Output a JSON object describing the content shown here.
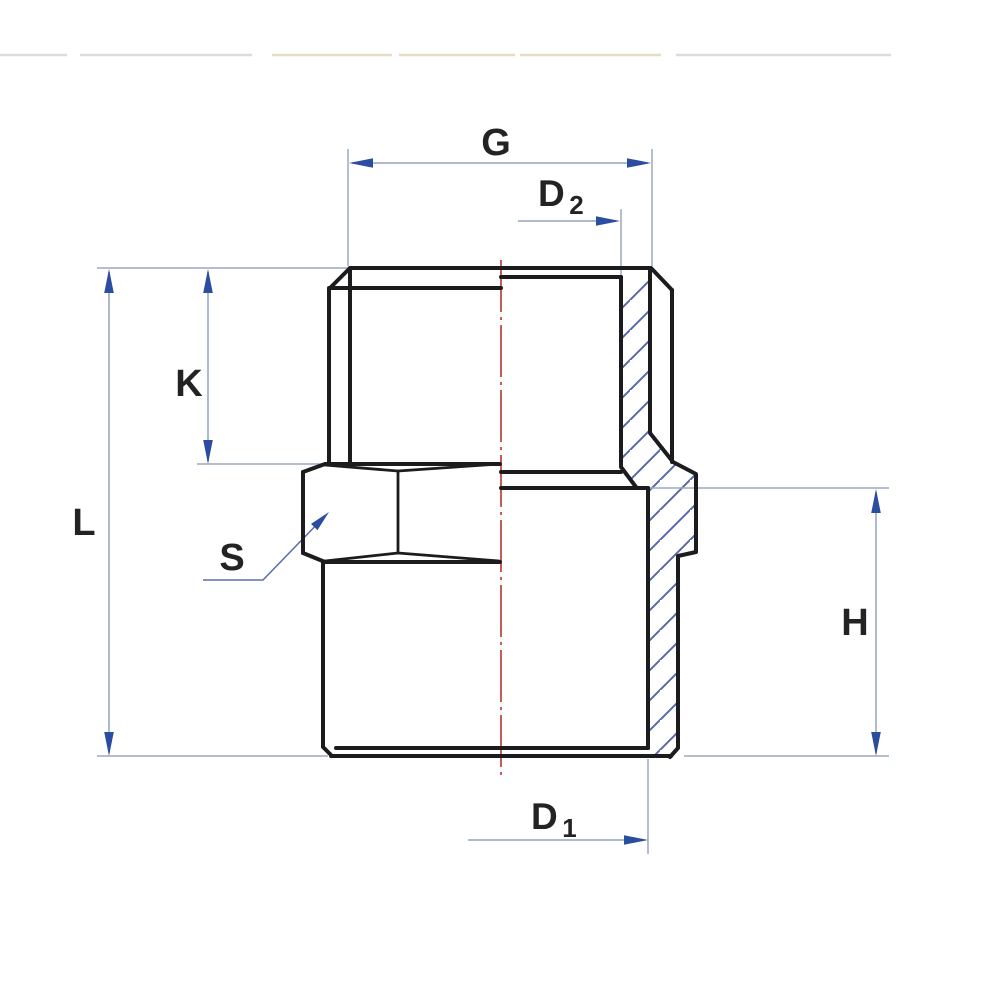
{
  "drawing": {
    "title": "Hex nipple pipe fitting - sectioned technical drawing",
    "view": "Side elevation, right half in section with hatching, vertical centerline",
    "labels": {
      "g": "G",
      "d2_base": "D",
      "d2_sub": "2",
      "k": "K",
      "l": "L",
      "s": "S",
      "h": "H",
      "d1_base": "D",
      "d1_sub": "1"
    },
    "colors": {
      "background": "#ffffff",
      "outline": "#1c1c1e",
      "text": "#232323",
      "dimension_line": "#94a3bd",
      "extension_line": "#9aa9c2",
      "arrow": "#2b4da0",
      "leader": "#5a6fb0",
      "hatch": "#5a68a8",
      "centerline": "#b5342e",
      "divider_gray": "#dcdcdc",
      "divider_tan": "#eadbc4"
    }
  }
}
